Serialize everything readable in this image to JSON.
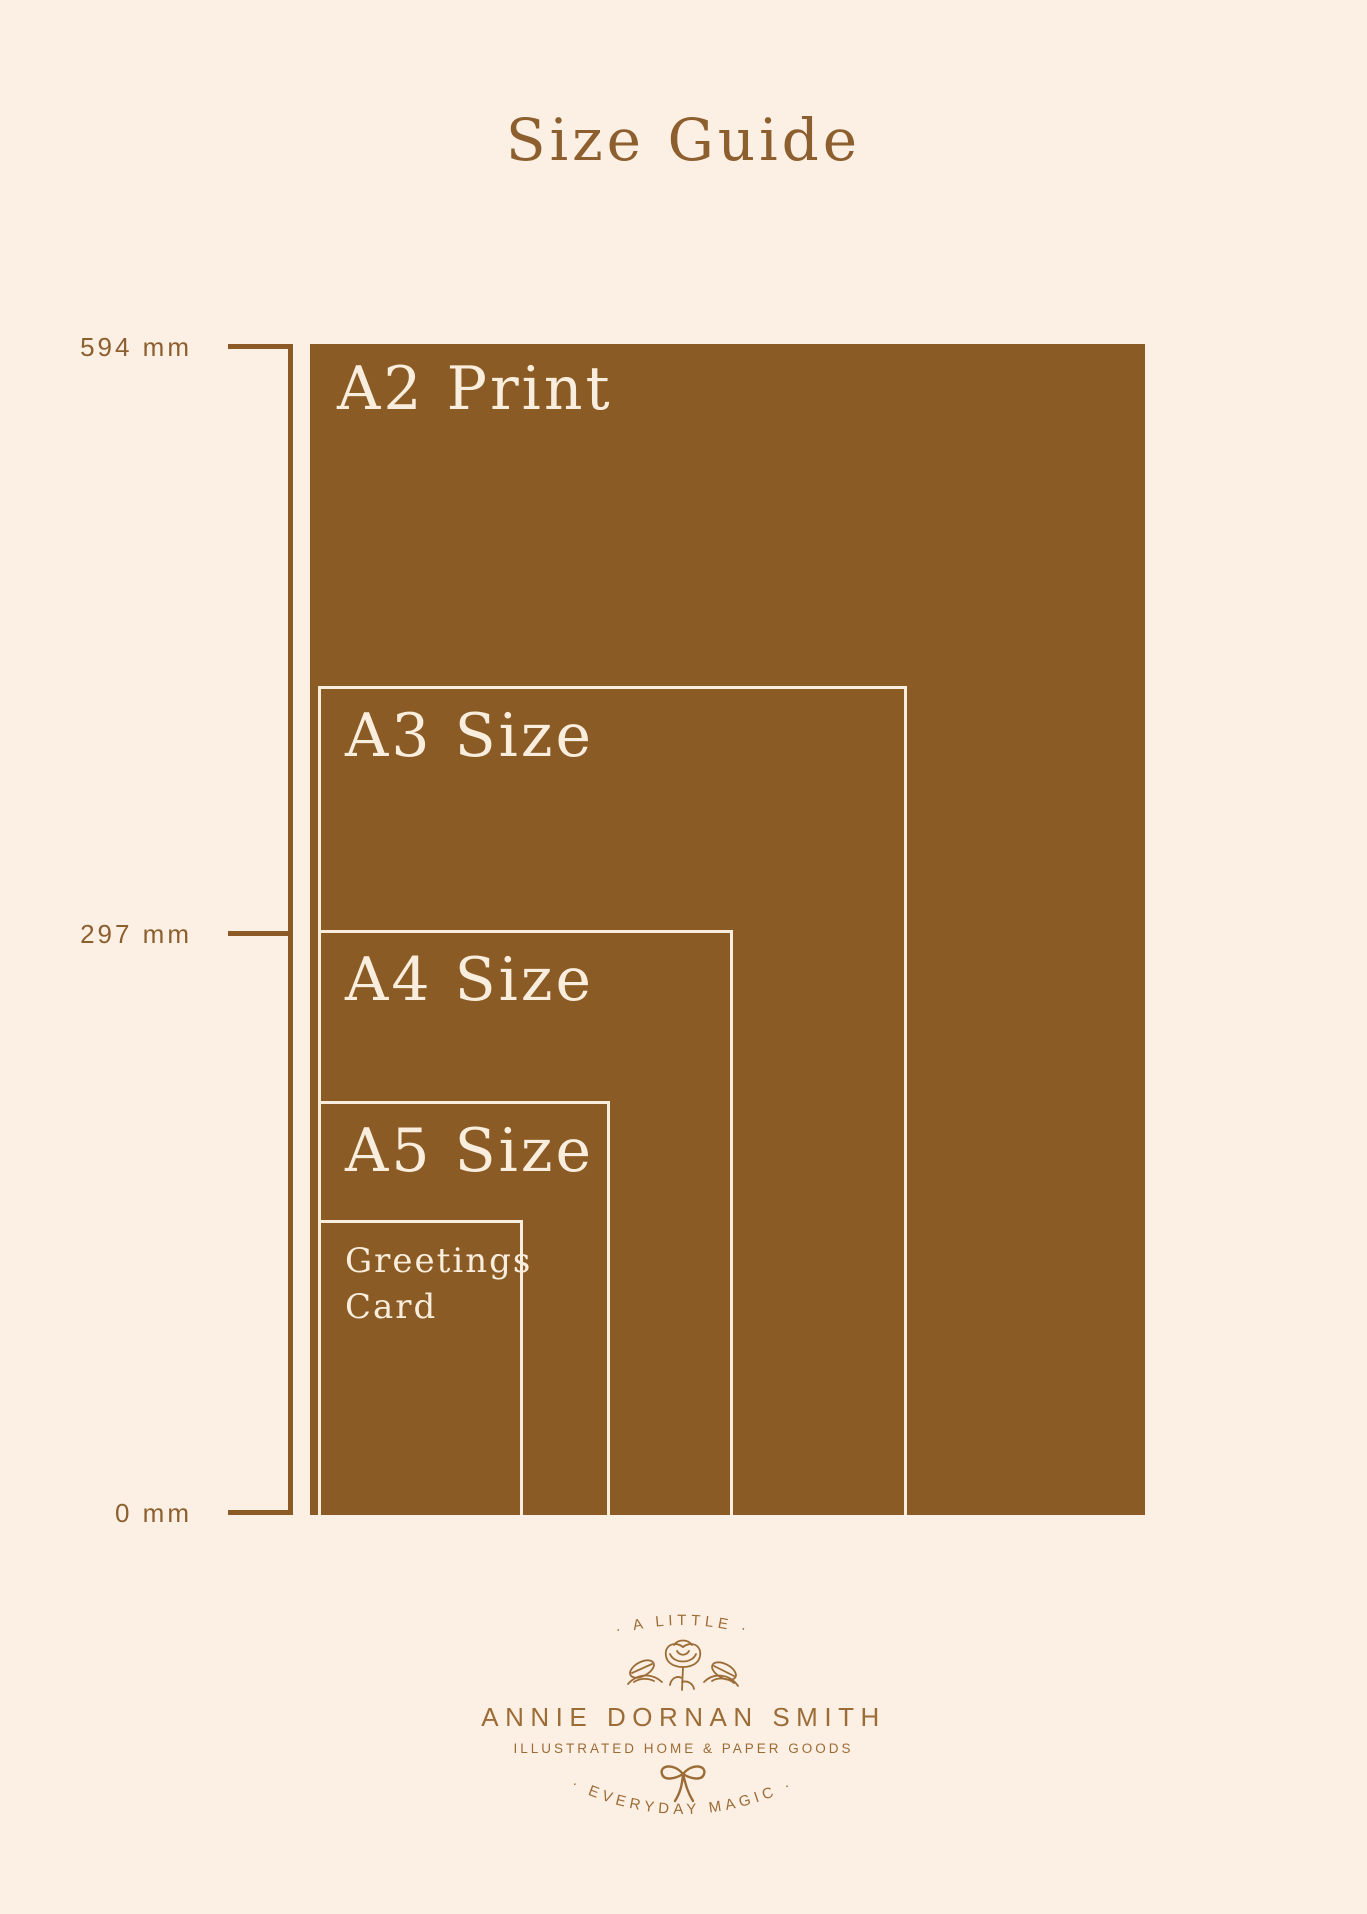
{
  "title": "Size Guide",
  "colors": {
    "background": "#FCF0E5",
    "panel_brown": "#8B5B25",
    "outline_cream": "#F9EEDE",
    "axis_text_brown": "#8D5F2E",
    "logo_brown": "#9C6C36"
  },
  "axis": {
    "top_label": "594 mm",
    "middle_label": "297 mm",
    "bottom_label": "0 mm"
  },
  "rectangles": [
    {
      "id": "a2",
      "label": "A2 Print"
    },
    {
      "id": "a3",
      "label": "A3 Size"
    },
    {
      "id": "a4",
      "label": "A4 Size"
    },
    {
      "id": "a5",
      "label": "A5 Size"
    },
    {
      "id": "greetings-card",
      "label": "Greetings\nCard"
    }
  ],
  "logo": {
    "arc_top": "· A LITTLE ·",
    "name": "ANNIE DORNAN SMITH",
    "tagline": "ILLUSTRATED HOME & PAPER GOODS",
    "arc_bottom": "· EVERYDAY MAGIC ·"
  }
}
